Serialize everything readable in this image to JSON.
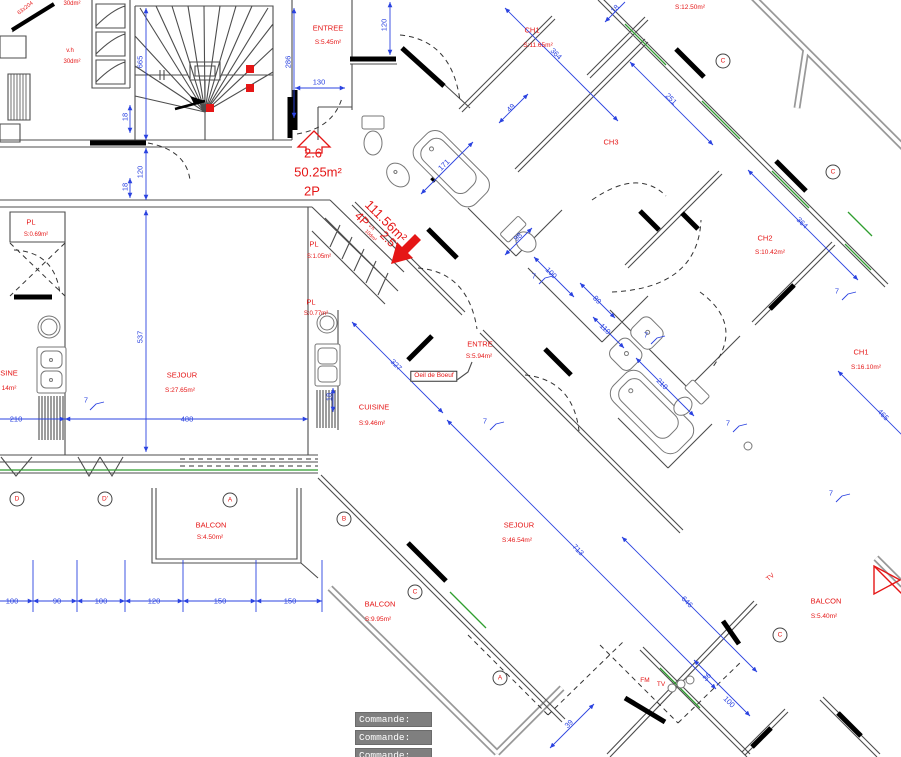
{
  "plan": {
    "colors": {
      "red": "#e51616",
      "blue": "#2b43e0",
      "green": "#2f9e2f",
      "wall": "#4d4d4d"
    },
    "unit_small": {
      "number": "2.6",
      "area": "50.25m²",
      "type": "2P"
    },
    "unit_large": {
      "number": "2.5",
      "area": "111.56m²",
      "type": "4P",
      "vent": "v.h",
      "vent_area": "10dm²"
    },
    "red_labels": [
      {
        "name": "room-entree",
        "t": "ENTREE",
        "x": 328,
        "y": 28
      },
      {
        "name": "room-area",
        "t": "S:5.45m²",
        "x": 328,
        "y": 43,
        "fs": 6.5
      },
      {
        "name": "room-ch1",
        "t": "CH1",
        "x": 532,
        "y": 30
      },
      {
        "name": "room-area",
        "t": "S:11.65m²",
        "x": 538,
        "y": 46,
        "fs": 6.5
      },
      {
        "name": "room-area",
        "t": "S:12.50m²",
        "x": 690,
        "y": 8,
        "fs": 6.5
      },
      {
        "name": "room-ch3",
        "t": "CH3",
        "x": 611,
        "y": 142
      },
      {
        "name": "room-ch2",
        "t": "CH2",
        "x": 765,
        "y": 238
      },
      {
        "name": "room-area",
        "t": "S:10.42m²",
        "x": 770,
        "y": 253,
        "fs": 6.5
      },
      {
        "name": "room-ch1",
        "t": "CH1",
        "x": 861,
        "y": 352
      },
      {
        "name": "room-area",
        "t": "S:16.10m²",
        "x": 866,
        "y": 368,
        "fs": 6.5
      },
      {
        "name": "room-pl",
        "t": "PL",
        "x": 31,
        "y": 222
      },
      {
        "name": "room-area",
        "t": "S:0.69m²",
        "x": 36,
        "y": 235,
        "fs": 6
      },
      {
        "name": "room-pl",
        "t": "PL",
        "x": 314,
        "y": 244
      },
      {
        "name": "room-area",
        "t": "S:1.05m²",
        "x": 319,
        "y": 257,
        "fs": 6
      },
      {
        "name": "room-pl",
        "t": "PL",
        "x": 311,
        "y": 302
      },
      {
        "name": "room-area",
        "t": "S:0.77m²",
        "x": 316,
        "y": 314,
        "fs": 6
      },
      {
        "name": "room-sejour",
        "t": "SEJOUR",
        "x": 182,
        "y": 375
      },
      {
        "name": "room-area",
        "t": "S:27.65m²",
        "x": 180,
        "y": 391,
        "fs": 6.5
      },
      {
        "name": "room-cuisine-clipped",
        "t": "SINE",
        "x": 9,
        "y": 373
      },
      {
        "name": "room-area",
        "t": "14m²",
        "x": 9,
        "y": 389,
        "fs": 6.5
      },
      {
        "name": "room-cuisine",
        "t": "CUISINE",
        "x": 374,
        "y": 407
      },
      {
        "name": "room-area",
        "t": "S:9.46m²",
        "x": 372,
        "y": 424,
        "fs": 6.5
      },
      {
        "name": "room-entre",
        "t": "ENTRE",
        "x": 480,
        "y": 344
      },
      {
        "name": "room-area",
        "t": "S:5.94m²",
        "x": 479,
        "y": 357,
        "fs": 6.5
      },
      {
        "name": "oeil-de-boeuf-label",
        "t": "Oeil de Boeuf",
        "x": 434,
        "y": 376,
        "fs": 6.5,
        "boxed": true
      },
      {
        "name": "room-sejour",
        "t": "SEJOUR",
        "x": 519,
        "y": 525
      },
      {
        "name": "room-area",
        "t": "S:46.54m²",
        "x": 517,
        "y": 541,
        "fs": 6.5
      },
      {
        "name": "room-balcon",
        "t": "BALCON",
        "x": 211,
        "y": 525
      },
      {
        "name": "room-area",
        "t": "S:4.50m²",
        "x": 210,
        "y": 538,
        "fs": 6.5
      },
      {
        "name": "room-balcon",
        "t": "BALCON",
        "x": 380,
        "y": 604
      },
      {
        "name": "room-area",
        "t": "S:9.95m²",
        "x": 378,
        "y": 620,
        "fs": 6.5
      },
      {
        "name": "room-balcon",
        "t": "BALCON",
        "x": 826,
        "y": 601
      },
      {
        "name": "room-area",
        "t": "S:5.40m²",
        "x": 824,
        "y": 617,
        "fs": 6.5
      },
      {
        "name": "outlet-fm",
        "t": "FM",
        "x": 645,
        "y": 681,
        "fs": 6.5
      },
      {
        "name": "outlet-tv",
        "t": "TV",
        "x": 661,
        "y": 685,
        "fs": 6.5
      },
      {
        "name": "outlet-tv",
        "t": "TV",
        "x": 771,
        "y": 578,
        "fs": 6.5,
        "r": -40
      },
      {
        "name": "vent-label",
        "t": "v.h",
        "x": 70,
        "y": 51,
        "fs": 6
      },
      {
        "name": "vent-area",
        "t": "30dm²",
        "x": 72,
        "y": 62,
        "fs": 6
      },
      {
        "name": "vent-area",
        "t": "30dm²",
        "x": 72,
        "y": 4,
        "fs": 6
      },
      {
        "name": "door-size",
        "t": "63x204",
        "x": 26,
        "y": 9,
        "fs": 5.5,
        "r": -38
      },
      {
        "name": "unit-number",
        "t": "2.6",
        "x": 313,
        "y": 153,
        "fs": 13
      },
      {
        "name": "unit-area",
        "t": "50.25m²",
        "x": 318,
        "y": 172,
        "fs": 13
      },
      {
        "name": "unit-type",
        "t": "2P",
        "x": 312,
        "y": 191,
        "fs": 13
      },
      {
        "name": "unit-area",
        "t": "111.56m²",
        "x": 386,
        "y": 221,
        "fs": 13,
        "r": 45
      },
      {
        "name": "unit-type",
        "t": "4P",
        "x": 362,
        "y": 219,
        "fs": 12,
        "r": 45
      },
      {
        "name": "vent-label",
        "t": "v.h",
        "x": 371,
        "y": 228,
        "fs": 5,
        "r": 45
      },
      {
        "name": "vent-area",
        "t": "10dm²",
        "x": 370,
        "y": 236,
        "fs": 5,
        "r": 45
      },
      {
        "name": "unit-number",
        "t": "2.5",
        "x": 388,
        "y": 239,
        "fs": 12,
        "r": 45
      }
    ],
    "blue_dims": [
      {
        "t": "100",
        "x": 12,
        "y": 601
      },
      {
        "t": "90",
        "x": 57,
        "y": 601
      },
      {
        "t": "100",
        "x": 101,
        "y": 601
      },
      {
        "t": "120",
        "x": 154,
        "y": 601
      },
      {
        "t": "150",
        "x": 220,
        "y": 601
      },
      {
        "t": "150",
        "x": 290,
        "y": 601
      },
      {
        "t": "210",
        "x": 16,
        "y": 419
      },
      {
        "t": "488",
        "x": 187,
        "y": 419
      },
      {
        "t": "7",
        "x": 86,
        "y": 400
      },
      {
        "t": "18",
        "x": 329,
        "y": 397,
        "r": -90
      },
      {
        "t": "537",
        "x": 140,
        "y": 337,
        "r": -90
      },
      {
        "t": "120",
        "x": 140,
        "y": 172,
        "r": -90
      },
      {
        "t": "18",
        "x": 125,
        "y": 117,
        "r": -90
      },
      {
        "t": "18",
        "x": 125,
        "y": 187,
        "r": -90
      },
      {
        "t": "665",
        "x": 140,
        "y": 62,
        "r": -90
      },
      {
        "t": "286",
        "x": 288,
        "y": 62,
        "r": -90
      },
      {
        "t": "130",
        "x": 319,
        "y": 82
      },
      {
        "t": "120",
        "x": 384,
        "y": 25,
        "r": -90
      },
      {
        "t": "49",
        "x": 511,
        "y": 108,
        "r": -45
      },
      {
        "t": "171",
        "x": 444,
        "y": 165,
        "r": -45
      },
      {
        "t": "18",
        "x": 615,
        "y": 9,
        "r": -45
      },
      {
        "t": "364",
        "x": 556,
        "y": 54,
        "r": 45
      },
      {
        "t": "251",
        "x": 671,
        "y": 99,
        "r": 45
      },
      {
        "t": "364",
        "x": 802,
        "y": 223,
        "r": 45
      },
      {
        "t": "7",
        "x": 837,
        "y": 291
      },
      {
        "t": "465",
        "x": 883,
        "y": 415,
        "r": 45
      },
      {
        "t": "327",
        "x": 396,
        "y": 365,
        "r": 45
      },
      {
        "t": "7",
        "x": 485,
        "y": 421
      },
      {
        "t": "7",
        "x": 534,
        "y": 276
      },
      {
        "t": "98",
        "x": 518,
        "y": 237,
        "r": -45
      },
      {
        "t": "100",
        "x": 551,
        "y": 273,
        "r": 45
      },
      {
        "t": "89",
        "x": 597,
        "y": 300,
        "r": 45
      },
      {
        "t": "110",
        "x": 605,
        "y": 329,
        "r": 45
      },
      {
        "t": "7",
        "x": 646,
        "y": 335
      },
      {
        "t": "210",
        "x": 662,
        "y": 384,
        "r": 45
      },
      {
        "t": "7",
        "x": 728,
        "y": 423
      },
      {
        "t": "713",
        "x": 578,
        "y": 550,
        "r": 45
      },
      {
        "t": "646",
        "x": 687,
        "y": 602,
        "r": 45
      },
      {
        "t": "7",
        "x": 831,
        "y": 493
      },
      {
        "t": "36",
        "x": 707,
        "y": 677,
        "r": -45
      },
      {
        "t": "100",
        "x": 729,
        "y": 702,
        "r": 45
      },
      {
        "t": "39",
        "x": 569,
        "y": 724,
        "r": -45
      }
    ],
    "markers": [
      {
        "t": "D",
        "x": 17,
        "y": 499
      },
      {
        "t": "D'",
        "x": 105,
        "y": 499
      },
      {
        "t": "A",
        "x": 230,
        "y": 500
      },
      {
        "t": "B",
        "x": 344,
        "y": 519
      },
      {
        "t": "C",
        "x": 415,
        "y": 592
      },
      {
        "t": "A",
        "x": 500,
        "y": 678
      },
      {
        "t": "C",
        "x": 723,
        "y": 61
      },
      {
        "t": "C",
        "x": 833,
        "y": 172
      },
      {
        "t": "C",
        "x": 780,
        "y": 635
      }
    ]
  },
  "command_panel": {
    "lines": [
      "Commande:",
      "Commande:",
      "Commande:"
    ]
  }
}
